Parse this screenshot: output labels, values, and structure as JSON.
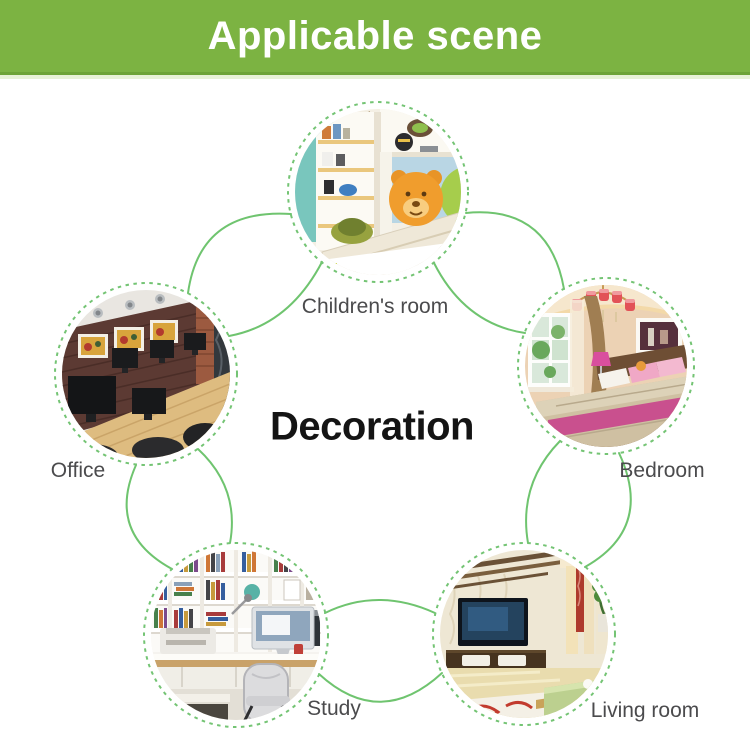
{
  "banner": {
    "title": "Applicable scene",
    "bg_color": "#7cb342",
    "text_color": "#ffffff"
  },
  "center": {
    "title": "Decoration",
    "color": "#141414"
  },
  "diagram": {
    "line_color": "#6fc46f",
    "dashed_ring_color": "#74c474",
    "label_color": "#4b4b4d",
    "scenes": [
      {
        "id": "childrens-room",
        "label": "Children's room",
        "photo": "children's room with white loft bed, corner shelves, toys and orange teddy-bear pillow"
      },
      {
        "id": "bedroom",
        "label": "Bedroom",
        "photo": "warm bedroom with chandelier, window, brown drape and bed with pink runner"
      },
      {
        "id": "living-room",
        "label": "Living room",
        "photo": "living room with wall TV, low cabinet, plant niche and green glass table"
      },
      {
        "id": "study",
        "label": "Study",
        "photo": "study with white bookshelves, desk, monitor, printer and chair"
      },
      {
        "id": "office",
        "label": "Office",
        "photo": "office meeting room with dark wood wall, three framed pictures and monitors on a wood table"
      }
    ]
  }
}
